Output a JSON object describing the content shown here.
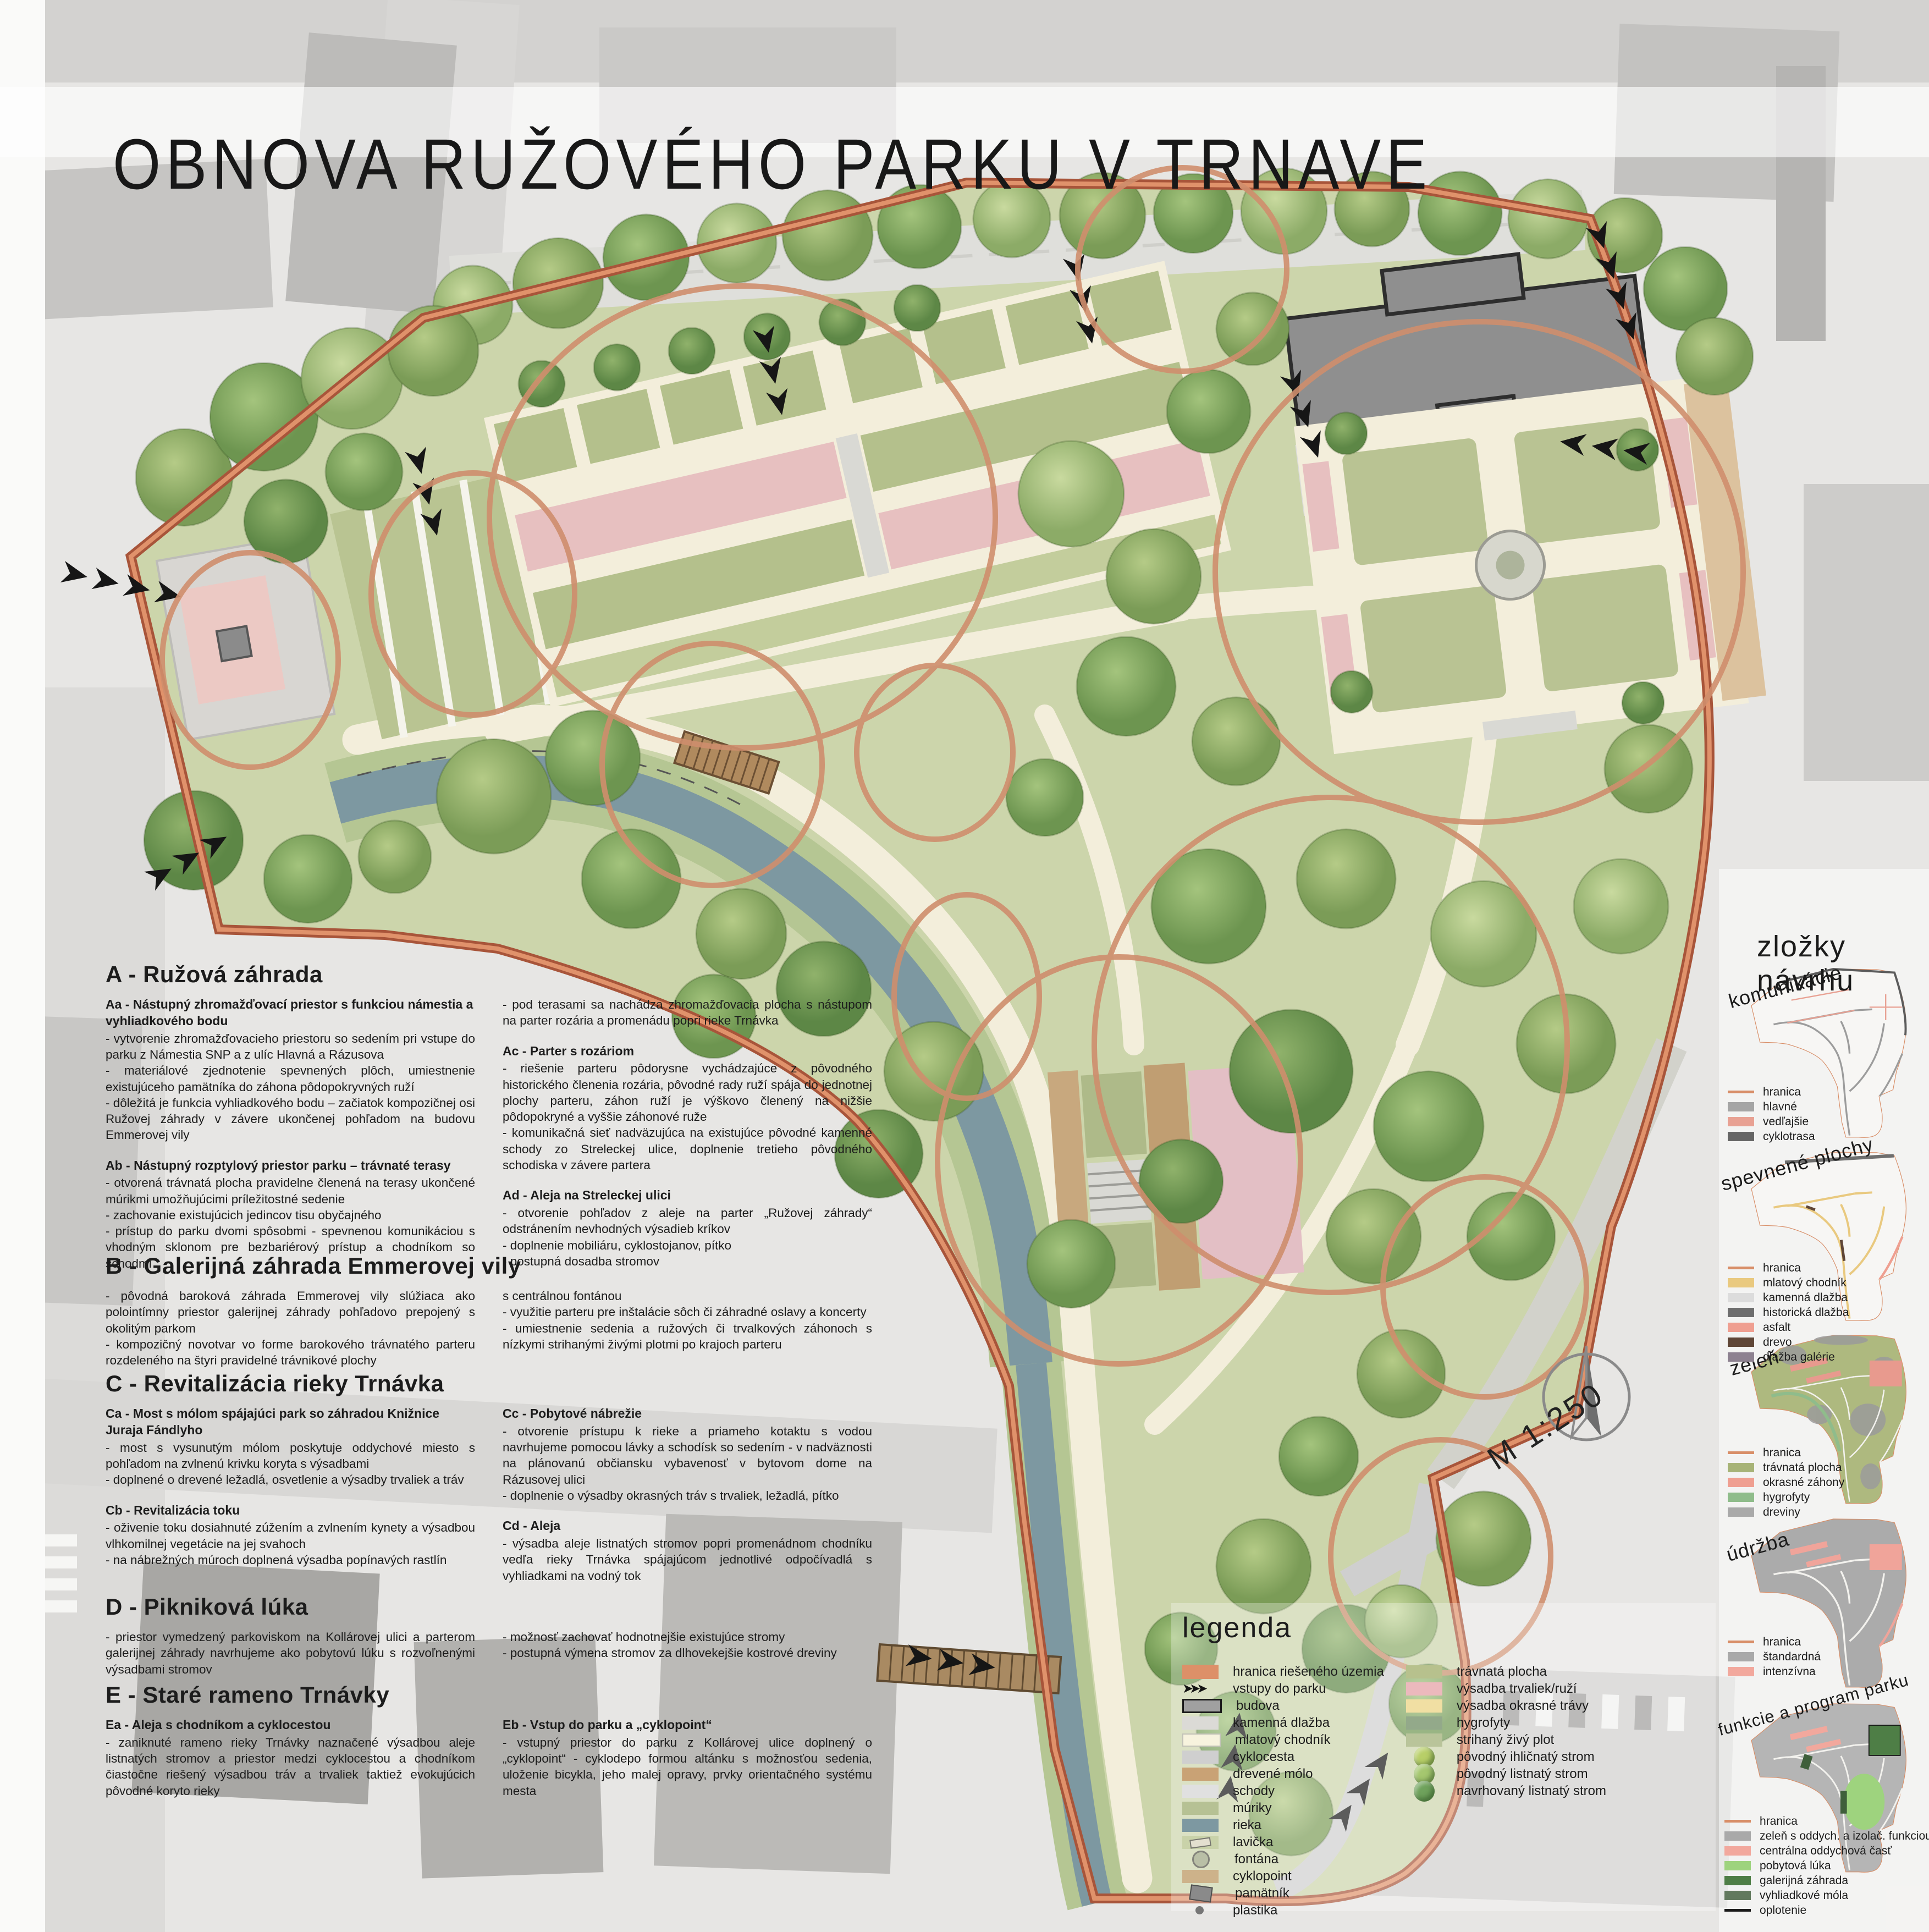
{
  "title": "OBNOVA RUŽOVÉHO PARKU V TRNAVE",
  "plan": {
    "scale": "M 1:250",
    "labels": [
      {
        "text": "Aa",
        "x": 13.0,
        "y": 33.9
      },
      {
        "text": "Ab",
        "x": 24.4,
        "y": 30.6
      },
      {
        "text": "Ac",
        "x": 38.5,
        "y": 26.2
      },
      {
        "text": "Ad",
        "x": 61.0,
        "y": 12.8
      },
      {
        "text": "B",
        "x": 75.4,
        "y": 27.8
      },
      {
        "text": "Ca",
        "x": 36.9,
        "y": 38.0
      },
      {
        "text": "Cb",
        "x": 49.7,
        "y": 47.8
      },
      {
        "text": "Cc",
        "x": 57.0,
        "y": 59.9
      },
      {
        "text": "Cd",
        "x": 48.5,
        "y": 37.1
      },
      {
        "text": "D",
        "x": 70.3,
        "y": 53.7
      },
      {
        "text": "Ea",
        "x": 76.7,
        "y": 66.5
      },
      {
        "text": "Eb",
        "x": 74.5,
        "y": 79.4
      }
    ]
  },
  "text": {
    "a": {
      "heading": "A - Ružová záhrada",
      "left": [
        {
          "title": "Aa - Nástupný zhromažďovací priestor s funkciou námestia a vyhliadkového bodu",
          "body": "- vytvorenie zhromažďovacieho priestoru so sedením pri vstupe do parku z Námestia SNP a z ulíc Hlavná a Rázusova\n- materiálové zjednotenie spevnených plôch, umiestnenie existujúceho pamätníka do záhona pôdopokryvných ruží\n- dôležitá je funkcia vyhliadkového bodu – začiatok kompozičnej osi Ružovej záhrady v závere ukončenej pohľadom na budovu Emmerovej vily"
        },
        {
          "title": "Ab - Nástupný rozptylový priestor parku – trávnaté terasy",
          "body": "- otvorená trávnatá plocha pravidelne členená na terasy ukončené múrikmi umožňujúcimi príležitostné sedenie\n- zachovanie existujúcich jedincov tisu obyčajného\n- prístup do parku dvomi spôsobmi - spevnenou komunikáciou s vhodným sklonom pre bezbariérový prístup a chodníkom so schodmi"
        }
      ],
      "right": [
        {
          "body": "- pod terasami sa nachádza zhromažďovacia plocha s nástupom na parter rozária a promenádu popri rieke Trnávka"
        },
        {
          "title": "Ac - Parter s rozáriom",
          "body": "- riešenie parteru pôdorysne vychádzajúce z pôvodného historického členenia rozária, pôvodné rady ruží spája do jednotnej plochy parteru, záhon ruží je výškovo členený na nižšie pôdopokryné a vyššie záhonové ruže\n- komunikačná sieť nadväzujúca na existujúce pôvodné kamenné schody zo Streleckej ulice, doplnenie tretieho pôvodného schodiska v závere partera"
        },
        {
          "title": "Ad - Aleja na Streleckej ulici",
          "body": "- otvorenie pohľadov z aleje na parter „Ružovej záhrady“ odstránením nevhodných výsadieb kríkov\n- doplnenie mobiliáru, cyklostojanov, pítko\n- postupná dosadba stromov"
        }
      ]
    },
    "b": {
      "heading": "B - Galerijná záhrada Emmerovej vily",
      "left": [
        {
          "body": "- pôvodná baroková záhrada Emmerovej vily slúžiaca ako polointímny priestor galerijnej záhrady pohľadovo prepojený s okolitým parkom\n- kompozičný novotvar vo forme barokového trávnatého parteru rozdeleného na štyri pravidelné trávnikové plochy"
        }
      ],
      "right": [
        {
          "body": "s centrálnou fontánou\n- využitie parteru pre inštalácie sôch či záhradné oslavy a koncerty\n- umiestnenie sedenia a ružových či trvalkových záhonoch s nízkymi strihanými živými plotmi po krajoch parteru"
        }
      ]
    },
    "c": {
      "heading": "C - Revitalizácia rieky Trnávka",
      "left": [
        {
          "title": "Ca - Most s mólom spájajúci park so záhradou Knižnice Juraja Fándlyho",
          "body": "- most s vysunutým mólom poskytuje oddychové miesto s pohľadom na zvlnenú krivku koryta s výsadbami\n- doplnené o drevené ležadlá, osvetlenie a výsadby trvaliek a tráv"
        },
        {
          "title": "Cb - Revitalizácia toku",
          "body": "- oživenie toku dosiahnuté zúžením a zvlnením kynety a výsadbou vlhkomilnej vegetácie na jej svahoch\n- na nábrežných múroch doplnená výsadba popínavých rastlín"
        }
      ],
      "right": [
        {
          "title": "Cc - Pobytové nábrežie",
          "body": "- otvorenie prístupu k rieke a priameho kotaktu s vodou navrhujeme pomocou lávky a schodísk so sedením - v nadväznosti na plánovanú občiansku vybavenosť v bytovom dome na Rázusovej ulici\n- doplnenie o výsadby okrasných tráv s trvaliek, ležadlá, pítko"
        },
        {
          "title": "Cd - Aleja",
          "body": "- výsadba aleje listnatých stromov popri promenádnom chodníku vedľa rieky Trnávka spájajúcom jednotlivé odpočívadlá s vyhliadkami na vodný tok"
        }
      ]
    },
    "d": {
      "heading": "D - Pikniková lúka",
      "left": [
        {
          "body": "- priestor vymedzený parkoviskom na Kollárovej ulici a parterom galerijnej záhrady navrhujeme ako pobytovú lúku s rozvoľnenými výsadbami stromov"
        }
      ],
      "right": [
        {
          "body": "- možnosť zachovať hodnotnejšie existujúce stromy\n- postupná výmena stromov za dlhovekejšie kostrové dreviny"
        }
      ]
    },
    "e": {
      "heading": "E - Staré rameno Trnávky",
      "left": [
        {
          "title": "Ea - Aleja s chodníkom a cyklocestou",
          "body": "- zaniknuté rameno rieky Trnávky naznačené výsadbou aleje listnatých stromov a priestor medzi cyklocestou a chodníkom čiastočne riešený výsadbou tráv a trvaliek taktiež evokujúcich pôvodné koryto rieky"
        }
      ],
      "right": [
        {
          "title": "Eb - Vstup do parku a „cyklopoint“",
          "body": "- vstupný priestor do parku z Kollárovej ulice doplnený o „cyklopoint“ - cyklodepo formou altánku s možnosťou sedenia, uloženie bicykla, jeho malej opravy, prvky orientačného systému mesta"
        }
      ]
    }
  },
  "legend": {
    "title": "legenda",
    "col1": [
      {
        "label": "hranica riešeného územia",
        "kind": "bar",
        "color": "#dd9068"
      },
      {
        "label": "vstupy do parku",
        "kind": "arrows",
        "glyph": "➤➤➤"
      },
      {
        "label": "budova",
        "kind": "rect-border",
        "color": "#a0a0a0"
      },
      {
        "label": "kamenná dlažba",
        "kind": "speckle",
        "color": "#dbdad6"
      },
      {
        "label": "mlatový chodník",
        "kind": "pale",
        "color": "#f7f3de"
      },
      {
        "label": "cyklocesta",
        "kind": "rect",
        "color": "#cfcfcf"
      },
      {
        "label": "drevené mólo",
        "kind": "wood",
        "color": "#c9a275"
      },
      {
        "label": "schody",
        "kind": "stairs",
        "color": "#e0e0e0"
      },
      {
        "label": "múriky",
        "kind": "walls",
        "color": "#b6c194"
      },
      {
        "label": "rieka",
        "kind": "rect",
        "color": "#7d98a1"
      },
      {
        "label": "lavička",
        "kind": "bench",
        "color": "#c9d2a9"
      },
      {
        "label": "fontána",
        "kind": "circle",
        "color": "#b9bfa6"
      },
      {
        "label": "cyklopoint",
        "kind": "wood",
        "color": "#cdb28a"
      },
      {
        "label": "pamätník",
        "kind": "mono",
        "color": "#8a8a8a"
      },
      {
        "label": "plastika",
        "kind": "dot",
        "color": "#767676"
      }
    ],
    "col2": [
      {
        "label": "trávnatá plocha",
        "kind": "rect",
        "color": "#b7c18d"
      },
      {
        "label": "výsadba trvaliek/ruží",
        "kind": "rect",
        "color": "#ecb9bd"
      },
      {
        "label": "výsadba okrasné trávy",
        "kind": "rect",
        "color": "#f1dfa3"
      },
      {
        "label": "hygrofyty",
        "kind": "hygro",
        "color": "#93a98a"
      },
      {
        "label": "strihaný živý plot",
        "kind": "hedge",
        "color": "#b9c49a"
      },
      {
        "label": "pôvodný ihličnatý strom",
        "kind": "tree",
        "color": "#b8cf68"
      },
      {
        "label": "pôvodný listnatý strom",
        "kind": "tree",
        "color": "#a5c76f"
      },
      {
        "label": "navrhovaný listnatý strom",
        "kind": "tree",
        "color": "#6fa25c"
      }
    ]
  },
  "sidebar": {
    "title": "zložky návrhu",
    "maps": [
      {
        "label": "komunikácie",
        "legend": [
          {
            "label": "hranica",
            "kind": "line",
            "color": "#d88e68"
          },
          {
            "label": "hlavné",
            "kind": "rect",
            "color": "#a5a5a5"
          },
          {
            "label": "vedľajšie",
            "kind": "rect",
            "color": "#e8a193"
          },
          {
            "label": "cyklotrasa",
            "kind": "rect",
            "color": "#666666"
          }
        ]
      },
      {
        "label": "spevnené plochy",
        "legend": [
          {
            "label": "hranica",
            "kind": "line",
            "color": "#d88e68"
          },
          {
            "label": "mlatový chodník",
            "kind": "rect",
            "color": "#e9c97f"
          },
          {
            "label": "kamenná dlažba",
            "kind": "rect",
            "color": "#dcdcdc"
          },
          {
            "label": "historická dlažba",
            "kind": "rect",
            "color": "#6e6e6e"
          },
          {
            "label": "asfalt",
            "kind": "rect",
            "color": "#ef9f91"
          },
          {
            "label": "drevo",
            "kind": "rect",
            "color": "#5f4637"
          },
          {
            "label": "dlažba galérie",
            "kind": "rect",
            "color": "#8d8190"
          }
        ]
      },
      {
        "label": "zeleň",
        "legend": [
          {
            "label": "hranica",
            "kind": "line",
            "color": "#d88e68"
          },
          {
            "label": "trávnatá plocha",
            "kind": "rect",
            "color": "#a7b377"
          },
          {
            "label": "okrasné záhony",
            "kind": "rect",
            "color": "#ef9f91"
          },
          {
            "label": "hygrofyty",
            "kind": "rect",
            "color": "#8fbc8b"
          },
          {
            "label": "dreviny",
            "kind": "rect",
            "color": "#a9a9a9"
          }
        ]
      },
      {
        "label": "údržba",
        "legend": [
          {
            "label": "hranica",
            "kind": "line",
            "color": "#d88e68"
          },
          {
            "label": "štandardná",
            "kind": "rect",
            "color": "#a9a9a9"
          },
          {
            "label": "intenzívna",
            "kind": "rect",
            "color": "#f2a89d"
          }
        ]
      },
      {
        "label": "funkcie a program parku",
        "legend": [
          {
            "label": "hranica",
            "kind": "line",
            "color": "#d88e68"
          },
          {
            "label": "zeleň s oddych. a izolač. funkciou",
            "kind": "rect",
            "color": "#a9a9a9"
          },
          {
            "label": "centrálna oddychová časť",
            "kind": "rect",
            "color": "#f2a89d"
          },
          {
            "label": "pobytová lúka",
            "kind": "rect",
            "color": "#9ed37e"
          },
          {
            "label": "galerijná záhrada",
            "kind": "rect",
            "color": "#4e7e46"
          },
          {
            "label": "vyhliadkové móla",
            "kind": "rect",
            "color": "#62795e"
          },
          {
            "label": "oplotenie",
            "kind": "line",
            "color": "#1a1a1a"
          }
        ]
      }
    ]
  }
}
